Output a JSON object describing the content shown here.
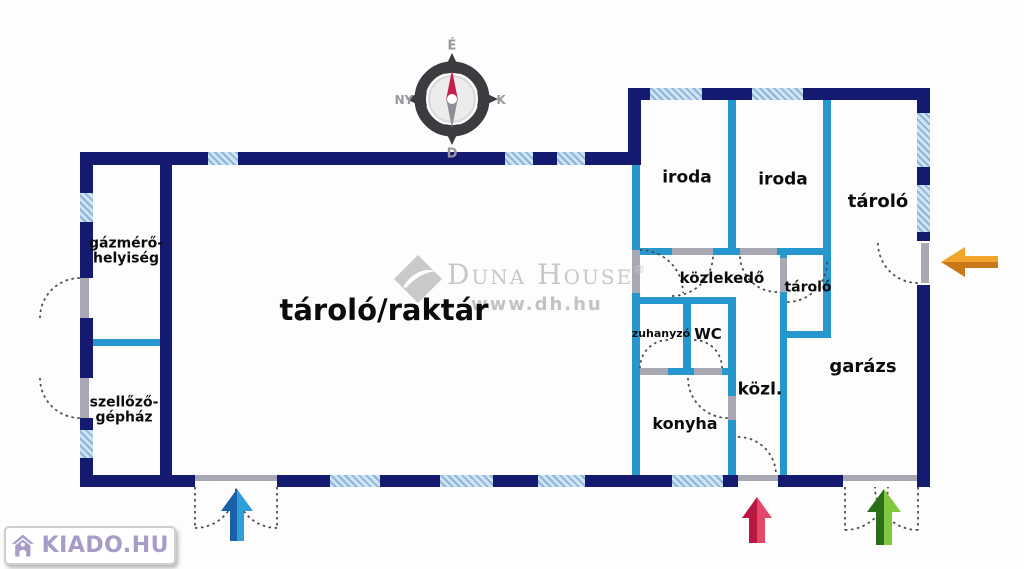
{
  "canvas": {
    "width": 1024,
    "height": 569
  },
  "compass": {
    "n": "É",
    "e": "K",
    "s": "D",
    "w": "NY"
  },
  "watermark": {
    "brand": "Duna House",
    "registered": "®",
    "url": "www.dh.hu"
  },
  "logo": {
    "text": "KIADO.HU"
  },
  "rooms": {
    "gazmero": {
      "lines": [
        "gázmérő-",
        "helyiség"
      ]
    },
    "szellozo": {
      "lines": [
        "szellőző-",
        "gépház"
      ]
    },
    "raktar": {
      "label": "tároló/raktár"
    },
    "iroda1": {
      "label": "iroda"
    },
    "iroda2": {
      "label": "iroda"
    },
    "tarolo_jobb": {
      "label": "tároló"
    },
    "kozlekedo": {
      "label": "közlekedő"
    },
    "tarolo_kis": {
      "label": "tároló"
    },
    "zuhanyzo": {
      "label": "zuhanyzó"
    },
    "wc": {
      "label": "WC"
    },
    "kozl": {
      "label": "közl."
    },
    "konyha": {
      "label": "konyha"
    },
    "garazs": {
      "label": "garázs"
    }
  },
  "colors": {
    "wall": "#141a70",
    "innerWall": "#2697cc",
    "windowFill": "#cfe3f3",
    "windowStripe": "#8cb5d8",
    "lintel": "#a8a8b4",
    "blueDark": "#1b5fa8",
    "blueLight": "#2f9fd8",
    "redDark": "#b81840",
    "redLight": "#e34868",
    "greenDark": "#2a6e1a",
    "greenLight": "#82c83e",
    "orangeDark": "#c87818",
    "orangeLight": "#f0a42c",
    "logoPurple": "#a79cc8",
    "watermarkGray": "#c8c8c8",
    "needleRed": "#c4204c"
  }
}
